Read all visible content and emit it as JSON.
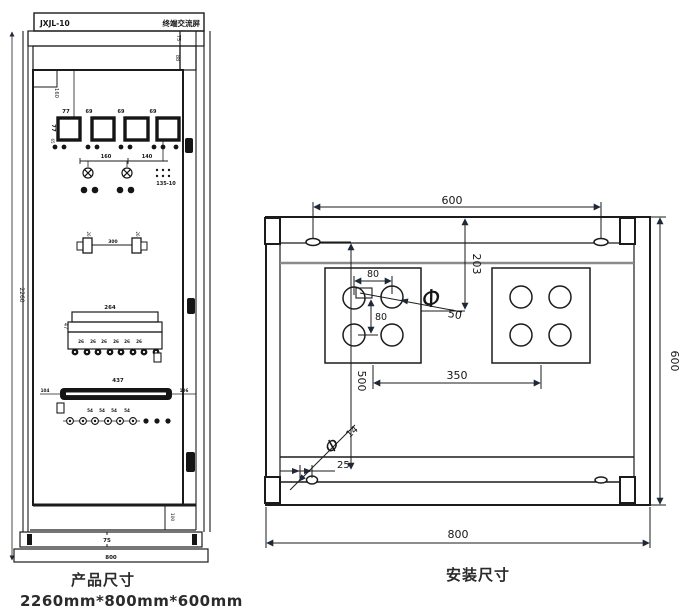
{
  "colors": {
    "line": "#1b1b1b",
    "arrow": "#1f2836",
    "text": "#161616",
    "background": "#ffffff",
    "gray_line": "#8a8a8a"
  },
  "product_view": {
    "caption": "产品尺寸",
    "size_note": "2260mm*800mm*600mm",
    "nameplate": {
      "model": "JXJL-10",
      "title": "终端交流屏"
    },
    "dims": {
      "overall_height": "2260",
      "top_band": "75",
      "second_band": "88",
      "panel_top_offset": "160",
      "meter_width": "77",
      "meter_height": "77",
      "meter_gap": "69",
      "meter_bottom": "65",
      "lamp_span_left": "160",
      "lamp_span_right": "140",
      "relay_label": "135-10",
      "bracket_width": "26",
      "bracket_span": "300",
      "strip_width": "264",
      "strip_height": "47",
      "terminal_pitch": "26",
      "busbar_length": "437",
      "busbar_left_offset": "104",
      "busbar_right_offset": "106",
      "lower_terminal_pitch": "54",
      "bottom_compartment": "100",
      "plinth_height": "75",
      "cabinet_width": "800"
    }
  },
  "install_view": {
    "caption": "安装尺寸",
    "dims": {
      "slot_span": "600",
      "overall_height": "600",
      "overall_width": "800",
      "top_to_hole": "203",
      "hole_pitch_h": "80",
      "hole_pitch_v": "80",
      "entry_hole_prefix": "Φ",
      "entry_hole_dia": "50",
      "center_span": "350",
      "slot_to_bolt": "500",
      "bolt_prefix": "Φ",
      "bolt_dia": "14",
      "bolt_edge_offset": "25"
    }
  }
}
